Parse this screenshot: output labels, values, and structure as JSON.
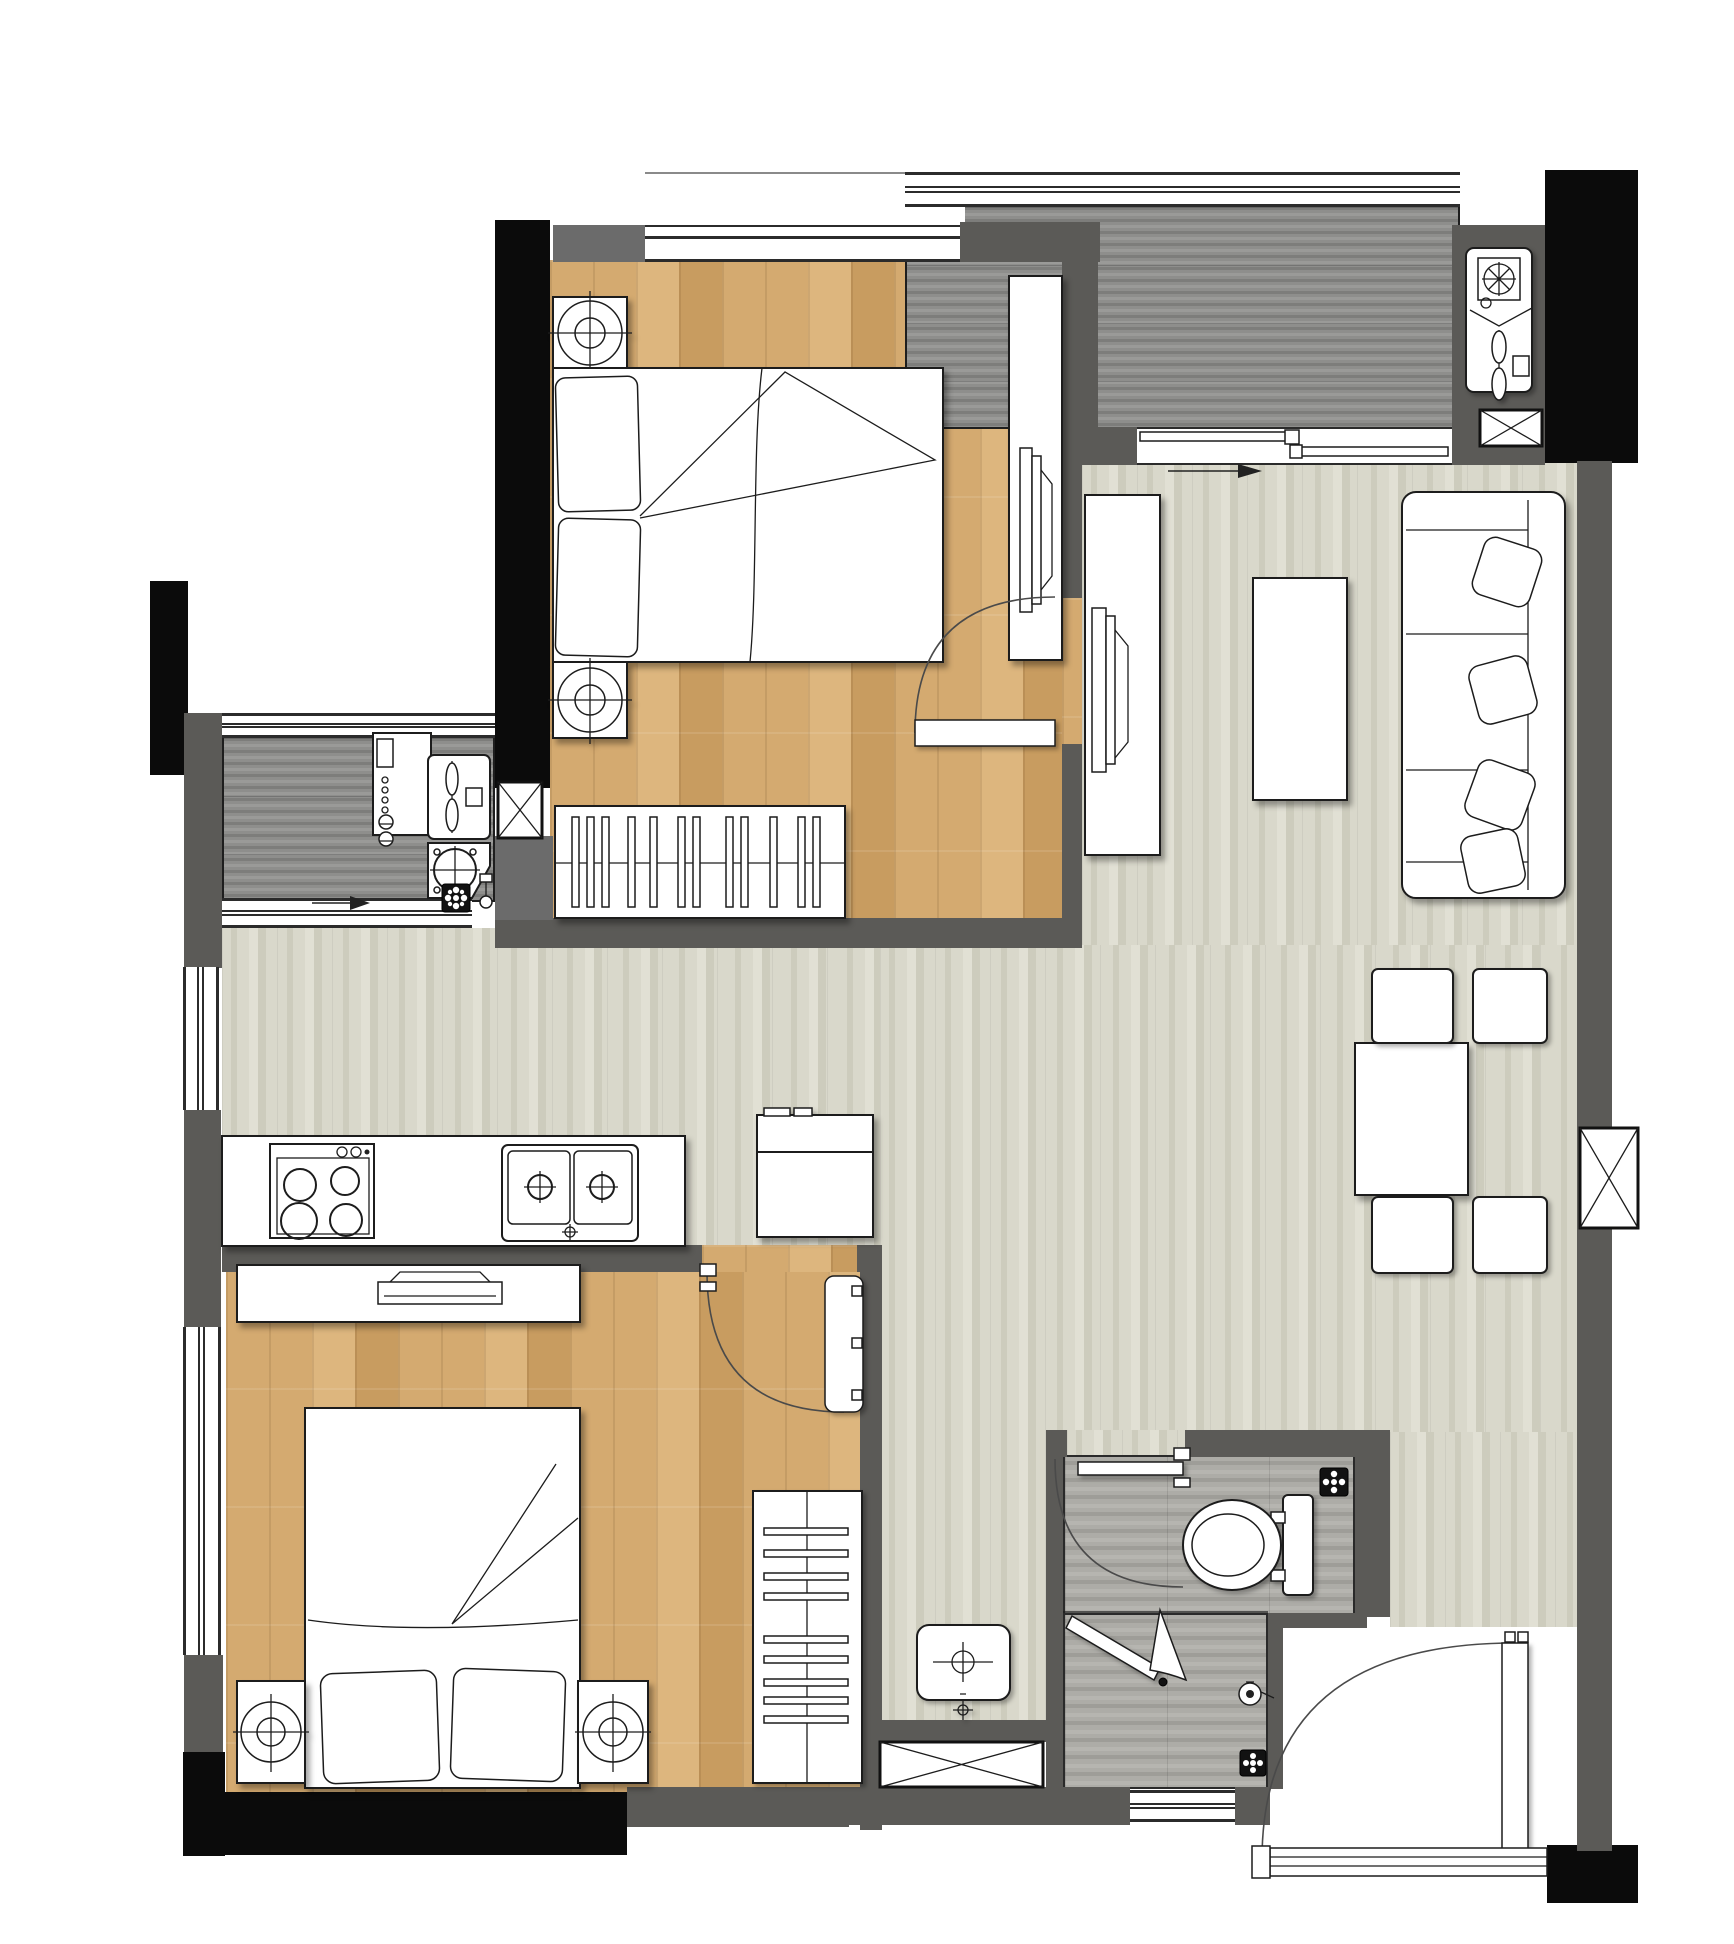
{
  "meta": {
    "document_type": "apartment floor plan rendering",
    "visible_text": [],
    "orientation": "top-down plan view"
  },
  "colors": {
    "bg": "#ffffff",
    "wall_dark": "#5b5a57",
    "wall_black": "#0b0b0b",
    "wall_med": "#6b6b6b",
    "line": "#1c1c1c",
    "wood1": "#d4aa70",
    "wood1b": "#c89c60",
    "wood1c": "#ddb67e",
    "gwood": "#8e8e8c",
    "gwood2": "#7d7d7b",
    "gwood3": "#9a9a98",
    "lfloor1": "#d9d8cb",
    "lfloor2": "#cdccbd",
    "lfloor3": "#e1e0d4",
    "bfloor1": "#adaca7",
    "bfloor2": "#9e9d98",
    "bfloor3": "#b6b5b0",
    "furniture_fill": "#ffffff"
  },
  "rooms": [
    {
      "id": "bedroom-1",
      "position": "top-left",
      "floor": "light wood plank",
      "fixtures": [
        "double-bed",
        "pillows",
        "two-nightstands-with-lamps",
        "slatted-wardrobe",
        "side-console-with-tv",
        "swing-door",
        "vent-hatch"
      ]
    },
    {
      "id": "balcony-top",
      "position": "top-right",
      "floor": "dark gray wood plank",
      "fixtures": [
        "ac-outdoor-units-panel",
        "vent-hatch",
        "sliding-door",
        "window-band",
        "direction-arrow"
      ]
    },
    {
      "id": "living-dining",
      "position": "right",
      "floor": "light gray striated tile",
      "fixtures": [
        "tv-console-with-tv",
        "coffee-table",
        "three-seat-sofa-with-cushions",
        "dining-table",
        "four-dining-chairs",
        "wall-vent-hatch"
      ]
    },
    {
      "id": "balcony-left",
      "position": "middle-left",
      "floor": "dark gray wood plank",
      "fixtures": [
        "washing-machine",
        "ac-outdoor-unit",
        "condenser-unit",
        "floor-drain",
        "faucet",
        "direction-arrow",
        "window-bands"
      ]
    },
    {
      "id": "kitchen-hall",
      "position": "middle",
      "floor": "light gray striated tile",
      "fixtures": [
        "counter",
        "four-burner-cooktop",
        "double-bowl-sink",
        "refrigerator",
        "side-window"
      ]
    },
    {
      "id": "bedroom-2",
      "position": "bottom-left",
      "floor": "light wood plank",
      "fixtures": [
        "double-bed",
        "pillows",
        "two-nightstands-with-lamps",
        "low-dresser-with-tray",
        "drawer-wardrobe",
        "swing-door",
        "window-wall"
      ]
    },
    {
      "id": "corridor-bath",
      "position": "bottom-middle",
      "floor": "light gray striated tile",
      "fixtures": [
        "wash-basin",
        "floor-drain-point",
        "storage-hatch"
      ]
    },
    {
      "id": "bathroom",
      "position": "bottom-right",
      "floor": "gray wood tile",
      "fixtures": [
        "toilet",
        "shower-screen",
        "hand-shower",
        "two-floor-drains",
        "swing-door",
        "window"
      ]
    },
    {
      "id": "entry",
      "position": "bottom-right-corner",
      "floor": "white tile",
      "fixtures": [
        "entry-swing-door",
        "threshold",
        "closet-nook"
      ]
    }
  ],
  "symbols": {
    "door_arcs": 4,
    "direction_arrows": 2,
    "vent_hatches_x": 4,
    "floor_drains": 3
  }
}
